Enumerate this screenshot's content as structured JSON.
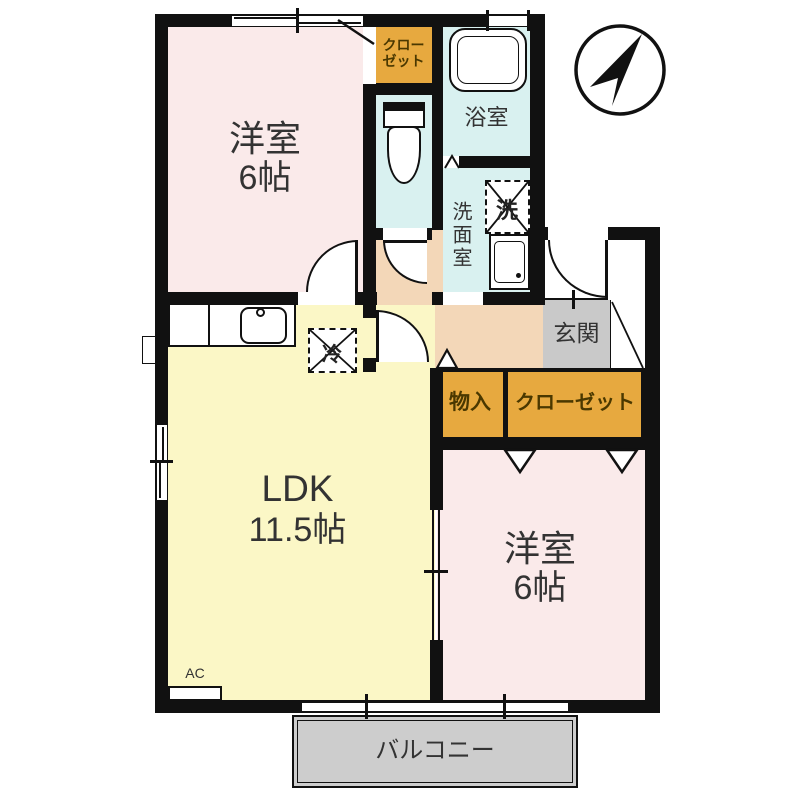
{
  "plan": {
    "type": "floorplan",
    "rooms": {
      "bedroom_tl": {
        "name": "洋室",
        "size": "6帖"
      },
      "bedroom_br": {
        "name": "洋室",
        "size": "6帖"
      },
      "ldk": {
        "name": "LDK",
        "size": "11.5帖"
      },
      "bath": {
        "label": "浴室"
      },
      "washroom": {
        "label": "洗面室"
      },
      "entrance": {
        "label": "玄関"
      },
      "closet_top": {
        "line1": "クロー",
        "line2": "ゼット"
      },
      "storage": {
        "label": "物入"
      },
      "closet_br": {
        "label": "クローゼット"
      },
      "balcony": {
        "label": "バルコニー"
      }
    },
    "symbols": {
      "washer": "洗",
      "fridge": "冷",
      "air_conditioner": "AC"
    },
    "colors": {
      "wall": "#111111",
      "bedroom_fill": "#faeaea",
      "ldk_fill": "#fbf7c6",
      "wet_area_fill": "#d9f1f0",
      "hall_fill": "#f3d7b8",
      "closet_fill": "#e7a93f",
      "entrance_fill": "#c9c9c9",
      "balcony_fill": "#cdcdcd",
      "closet_text": "#4a3800",
      "label_text": "#333333"
    }
  }
}
